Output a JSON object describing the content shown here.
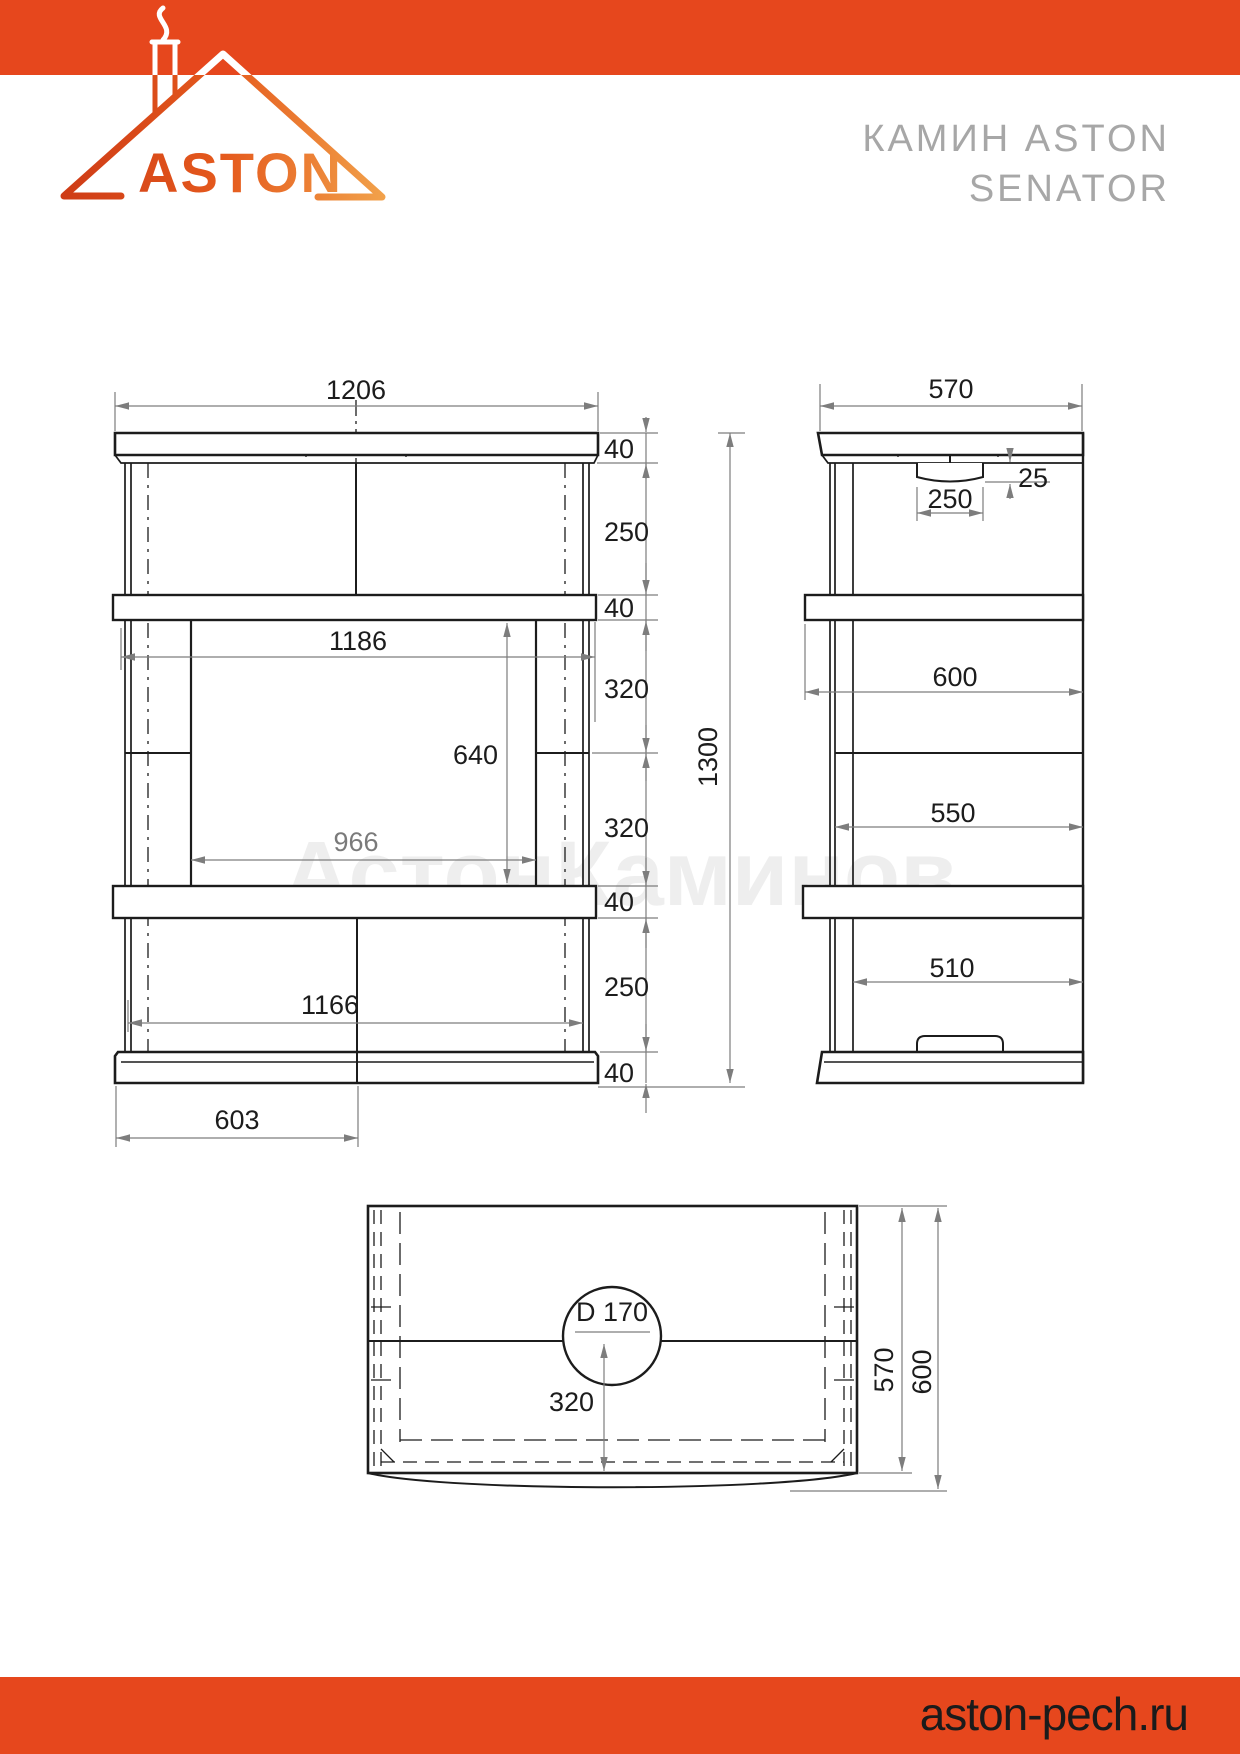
{
  "header": {
    "brand": "ASTON",
    "title_line1": "КАМИН ASTON",
    "title_line2": "SENATOR"
  },
  "footer": {
    "website": "aston-pech.ru"
  },
  "watermark": "АстонКаминов",
  "colors": {
    "accent": "#E6471D",
    "drawing_line": "#1c1c1c",
    "dimension_line": "#7d7d7d",
    "title_gray": "#a7a7a7",
    "logo_gradient_start": "#CE3B16",
    "logo_gradient_end": "#F2A44C"
  },
  "front_view": {
    "overall_width": "1206",
    "shelf_width": "1186",
    "opening_width": "966",
    "opening_height": "640",
    "lower_width": "1166",
    "half_width": "603",
    "total_height": "1300",
    "top_slab_thickness": "40",
    "upper_section_height": "250",
    "shelf_thickness": "40",
    "opening_upper_part": "320",
    "opening_lower_part": "320",
    "hearth_shelf_thickness": "40",
    "lower_section_height": "250",
    "base_thickness": "40"
  },
  "side_view": {
    "depth": "570",
    "flue_recess": "25",
    "flue_width": "250",
    "shelf_depth": "600",
    "middle_depth": "550",
    "lower_depth": "510"
  },
  "top_view": {
    "flue_diameter": "D 170",
    "flue_center_distance": "320",
    "body_depth": "570",
    "overall_depth": "600"
  }
}
